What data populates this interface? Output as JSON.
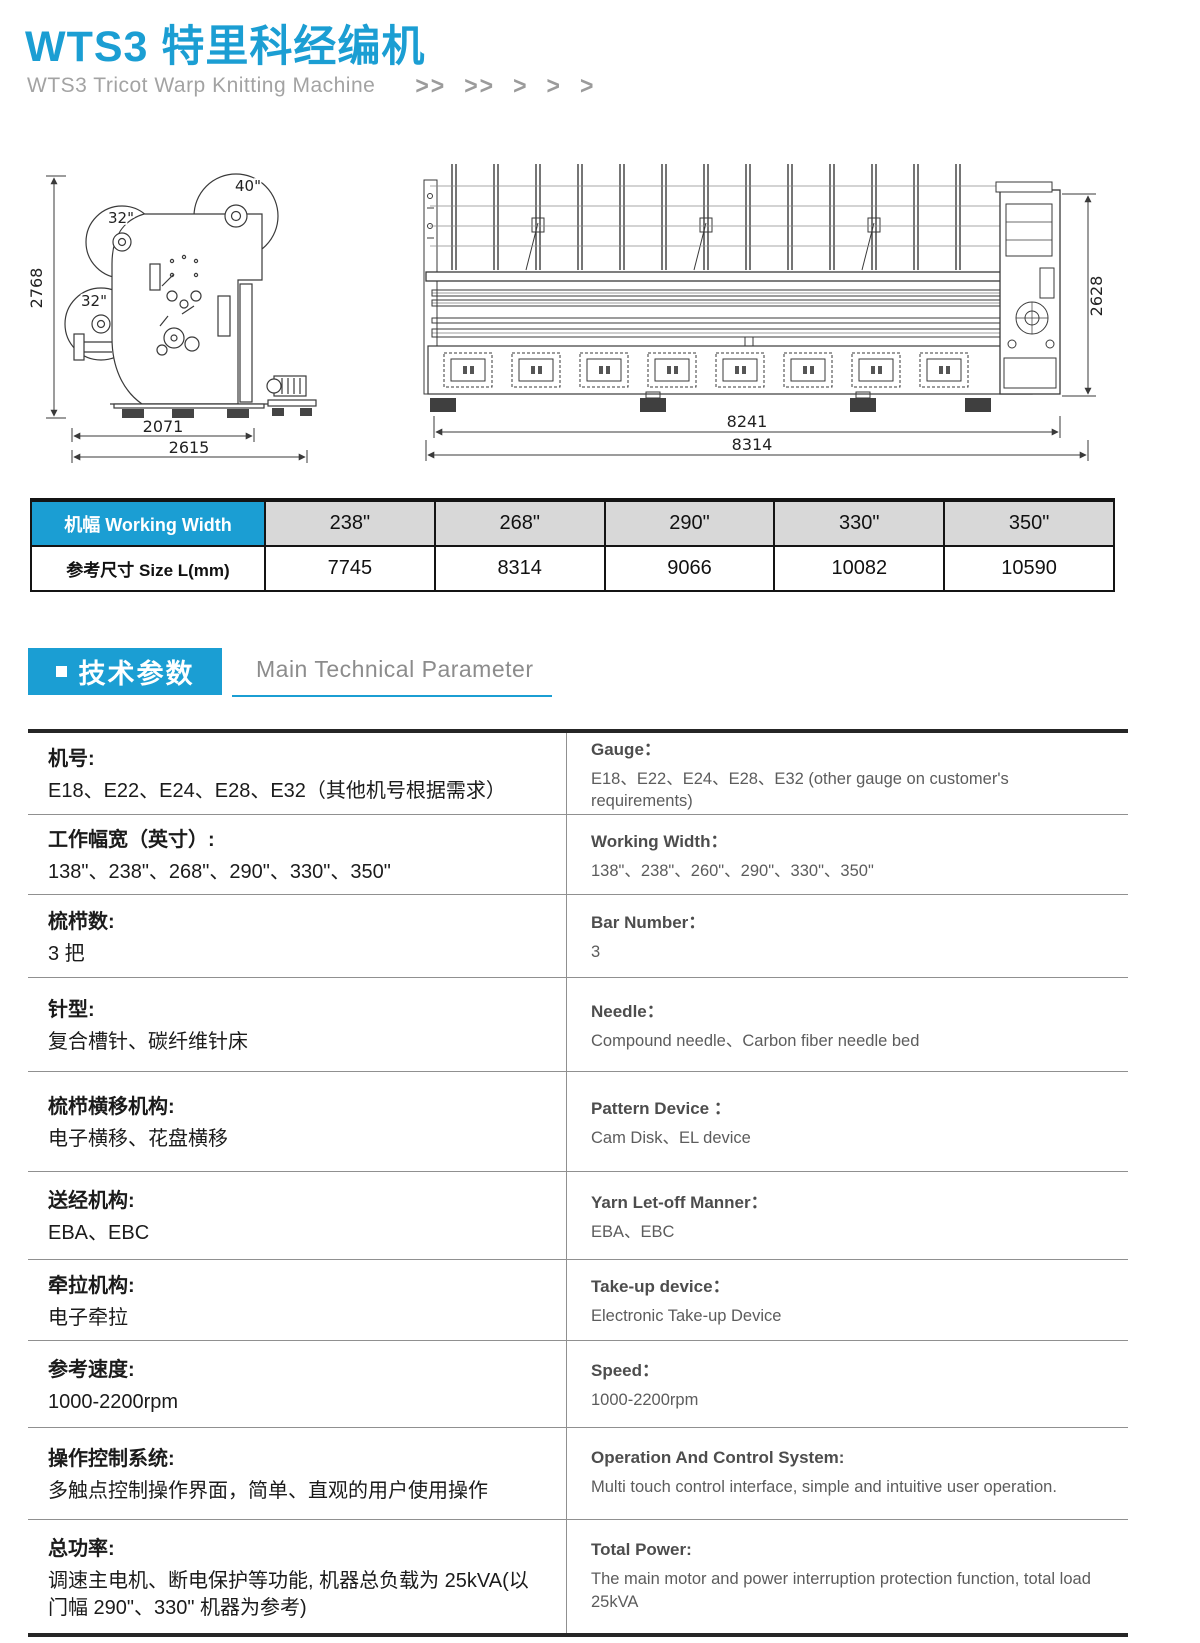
{
  "header": {
    "title": "WTS3 特里科经编机",
    "subtitle": "WTS3 Tricot Warp Knitting Machine",
    "chevrons": [
      ">>",
      ">>",
      ">",
      ">",
      ">"
    ]
  },
  "diagrams": {
    "side_view": {
      "dim_height": "2768",
      "dim_width_inner": "2071",
      "dim_width_outer": "2615",
      "beam_top": "40\"",
      "beam_upper": "32\"",
      "beam_lower": "32\""
    },
    "front_view": {
      "dim_height": "2628",
      "dim_width_inner": "8241",
      "dim_width_outer": "8314"
    }
  },
  "size_table": {
    "col_header": "机幅 Working Width",
    "row_header": "参考尺寸 Size L(mm)",
    "working_widths": [
      "238\"",
      "268\"",
      "290\"",
      "330\"",
      "350\""
    ],
    "sizes_mm": [
      "7745",
      "8314",
      "9066",
      "10082",
      "10590"
    ]
  },
  "section_header": {
    "zh": "技术参数",
    "en": "Main Technical Parameter"
  },
  "parameters": [
    {
      "zh_label": "机号:",
      "zh_value": "E18、E22、E24、E28、E32（其他机号根据需求）",
      "en_label": "Gauge：",
      "en_value": "E18、E22、E24、E28、E32 (other gauge on customer's requirements)"
    },
    {
      "zh_label": "工作幅宽（英寸）:",
      "zh_value": "138\"、238\"、268\"、290\"、330\"、350\"",
      "en_label": "Working Width：",
      "en_value": "138\"、238\"、260\"、290\"、330\"、350\""
    },
    {
      "zh_label": "梳栉数:",
      "zh_value": "3 把",
      "en_label": "Bar Number：",
      "en_value": "3"
    },
    {
      "zh_label": "针型:",
      "zh_value": "复合槽针、碳纤维针床",
      "en_label": "Needle：",
      "en_value": "Compound needle、Carbon fiber needle bed"
    },
    {
      "zh_label": "梳栉横移机构:",
      "zh_value": "电子横移、花盘横移",
      "en_label": "Pattern Device ：",
      "en_value": "Cam Disk、EL device"
    },
    {
      "zh_label": "送经机构:",
      "zh_value": "EBA、EBC",
      "en_label": "Yarn Let-off Manner：",
      "en_value": "EBA、EBC"
    },
    {
      "zh_label": "牵拉机构:",
      "zh_value": "电子牵拉",
      "en_label": "Take-up device：",
      "en_value": "Electronic Take-up Device"
    },
    {
      "zh_label": "参考速度:",
      "zh_value": "1000-2200rpm",
      "en_label": "Speed：",
      "en_value": "1000-2200rpm"
    },
    {
      "zh_label": "操作控制系统:",
      "zh_value": "多触点控制操作界面，简单、直观的用户使用操作",
      "en_label": "Operation And Control System:",
      "en_value": "Multi touch control interface, simple and intuitive user operation."
    },
    {
      "zh_label": "总功率:",
      "zh_value": "调速主电机、断电保护等功能, 机器总负载为 25kVA(以门幅 290\"、330\" 机器为参考)",
      "en_label": "Total Power:",
      "en_value": "The main motor and power interruption protection function,  total load 25kVA"
    }
  ],
  "colors": {
    "accent": "#1b9ed3",
    "table_header_bg": "#d8d8d8",
    "line_dark": "#141414",
    "line_gray": "#909090"
  }
}
